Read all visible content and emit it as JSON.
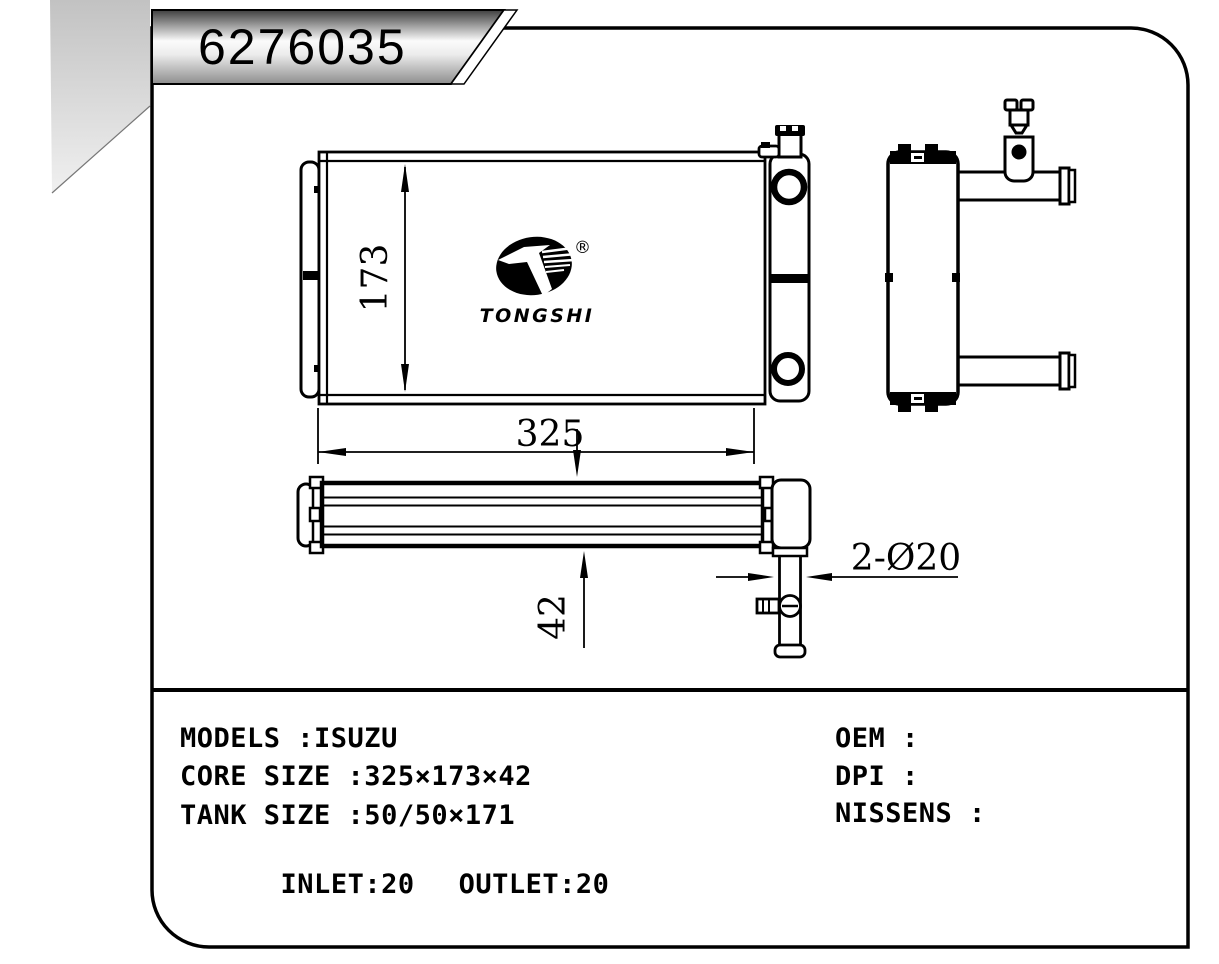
{
  "title_banner": {
    "part_number": "6276035"
  },
  "logo": {
    "brand": "TONGSHI",
    "registered": "®"
  },
  "dimensions": {
    "core_height": "173",
    "core_width": "325",
    "core_thickness": "42",
    "pipe_diameter": "2-Ø20"
  },
  "specs": {
    "models_line": "MODELS :ISUZU",
    "core_size_line": "CORE SIZE :325×173×42",
    "tank_size_line": "TANK SIZE :50/50×171",
    "inlet": "INLET:20",
    "outlet": "OUTLET:20",
    "oem_line": "OEM :",
    "dpi_line": "DPI :",
    "nissens_line": "NISSENS :"
  }
}
